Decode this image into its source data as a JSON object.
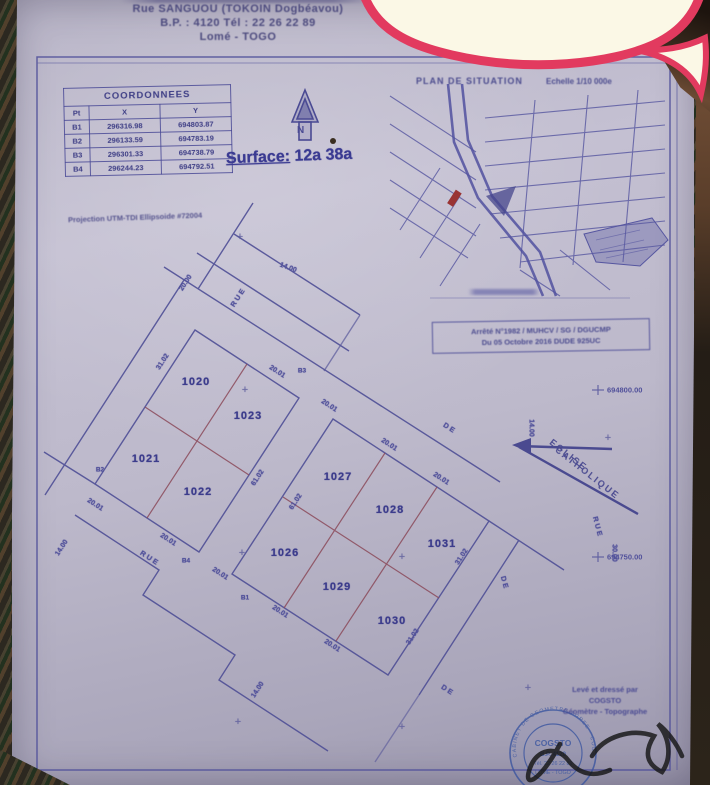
{
  "colors": {
    "paper": "#bcb8ca",
    "ink_blue": "#4f4f96",
    "ink_red": "#8b4a5a",
    "bubble_pink": "#e23a5f",
    "bubble_cream": "#fbf8e6",
    "stamp_blue": "#3a55a0",
    "signature": "#1a1a1a"
  },
  "letterhead": {
    "line1": "Rue SANGUOU (TOKOIN Dogbéavou)",
    "line2": "B.P. : 4120    Tél : 22 26 22 89",
    "line3": "Lomé - TOGO"
  },
  "coordinates_table": {
    "title": "COORDONNEES",
    "columns": [
      "Pt",
      "X",
      "Y"
    ],
    "rows": [
      [
        "B1",
        "296316.98",
        "694803.87"
      ],
      [
        "B2",
        "296133.59",
        "694783.19"
      ],
      [
        "B3",
        "296301.33",
        "694738.79"
      ],
      [
        "B4",
        "296244.23",
        "694792.51"
      ]
    ]
  },
  "projection_note": "Projection UTM-TDI  Ellipsoide #72004",
  "surface_label_title": "Surface:",
  "surface_label_value": "12a 38a",
  "north_label": "N",
  "situation_map": {
    "title": "PLAN DE SITUATION",
    "scale": "Echelle 1/10 000e"
  },
  "decree_box": {
    "line1": "Arrêté N°1982 / MUHCV / SG / DGUCMP",
    "line2": "Du 05 Octobre 2016   DUDE 925UC"
  },
  "grid_labels": [
    {
      "text": "694800.00",
      "x": 607,
      "y": 390
    },
    {
      "text": "694750.00",
      "x": 607,
      "y": 557
    }
  ],
  "plan": {
    "church_label": {
      "line1": "EGLISE",
      "line2": "CATHOLIQUE"
    },
    "parcels": [
      {
        "number": "1020",
        "x": 196,
        "y": 382
      },
      {
        "number": "1023",
        "x": 248,
        "y": 416
      },
      {
        "number": "1021",
        "x": 146,
        "y": 459
      },
      {
        "number": "1022",
        "x": 198,
        "y": 492
      },
      {
        "number": "1027",
        "x": 338,
        "y": 477
      },
      {
        "number": "1028",
        "x": 390,
        "y": 510
      },
      {
        "number": "1031",
        "x": 442,
        "y": 544
      },
      {
        "number": "1026",
        "x": 285,
        "y": 553
      },
      {
        "number": "1029",
        "x": 337,
        "y": 587
      },
      {
        "number": "1030",
        "x": 392,
        "y": 621
      }
    ],
    "dimensions": [
      {
        "text": "14.00",
        "x": 288,
        "y": 268,
        "rot": 20
      },
      {
        "text": "20.00",
        "x": 186,
        "y": 283,
        "rot": -57
      },
      {
        "text": "31.02",
        "x": 163,
        "y": 362,
        "rot": -57
      },
      {
        "text": "20.01",
        "x": 277,
        "y": 372,
        "rot": 33
      },
      {
        "text": "20.01",
        "x": 329,
        "y": 406,
        "rot": 33
      },
      {
        "text": "20.01",
        "x": 389,
        "y": 445,
        "rot": 33
      },
      {
        "text": "20.01",
        "x": 441,
        "y": 479,
        "rot": 33
      },
      {
        "text": "61.02",
        "x": 258,
        "y": 478,
        "rot": -57
      },
      {
        "text": "61.02",
        "x": 296,
        "y": 502,
        "rot": -57
      },
      {
        "text": "31.02",
        "x": 462,
        "y": 557,
        "rot": -57
      },
      {
        "text": "31.02",
        "x": 413,
        "y": 637,
        "rot": -57
      },
      {
        "text": "20.01",
        "x": 168,
        "y": 540,
        "rot": 33
      },
      {
        "text": "20.01",
        "x": 220,
        "y": 574,
        "rot": 33
      },
      {
        "text": "20.01",
        "x": 280,
        "y": 612,
        "rot": 33
      },
      {
        "text": "20.01",
        "x": 332,
        "y": 646,
        "rot": 33
      },
      {
        "text": "20.01",
        "x": 95,
        "y": 505,
        "rot": 33
      },
      {
        "text": "14.00",
        "x": 62,
        "y": 548,
        "rot": -57
      },
      {
        "text": "14.00",
        "x": 258,
        "y": 690,
        "rot": -57
      },
      {
        "text": "14.00",
        "x": 531,
        "y": 428,
        "rot": 90
      },
      {
        "text": "30.00",
        "x": 614,
        "y": 553,
        "rot": 90
      }
    ],
    "streets": [
      {
        "text": "RUE",
        "x": 238,
        "y": 297,
        "rot": -57
      },
      {
        "text": "RUE",
        "x": 150,
        "y": 558,
        "rot": 33
      },
      {
        "text": "RUE",
        "x": 598,
        "y": 527,
        "rot": 75
      },
      {
        "text": "DE",
        "x": 450,
        "y": 428,
        "rot": 33
      },
      {
        "text": "DE",
        "x": 505,
        "y": 583,
        "rot": 75
      },
      {
        "text": "DE",
        "x": 448,
        "y": 690,
        "rot": 33
      }
    ],
    "points": [
      {
        "text": "B3",
        "x": 302,
        "y": 371
      },
      {
        "text": "B4",
        "x": 186,
        "y": 561
      },
      {
        "text": "B1",
        "x": 245,
        "y": 598
      },
      {
        "text": "B2",
        "x": 100,
        "y": 470
      }
    ],
    "crosses": [
      {
        "x": 240,
        "y": 237
      },
      {
        "x": 245,
        "y": 390
      },
      {
        "x": 242,
        "y": 553
      },
      {
        "x": 402,
        "y": 557
      },
      {
        "x": 608,
        "y": 438
      },
      {
        "x": 238,
        "y": 722
      },
      {
        "x": 402,
        "y": 727
      },
      {
        "x": 528,
        "y": 688
      }
    ]
  },
  "credit_block": {
    "line1": "Levé et dressé par",
    "line2": "COGSTO",
    "line3": "Géomètre - Topographe"
  },
  "stamp": {
    "ring": "CABINET DE GEOMETRE AGREE · COGSTO ·",
    "line1": "COGSTO",
    "line2": "B.P. 4120",
    "line3": "Tél. 22 26 22 89",
    "line4": "LOME - TOGO"
  }
}
